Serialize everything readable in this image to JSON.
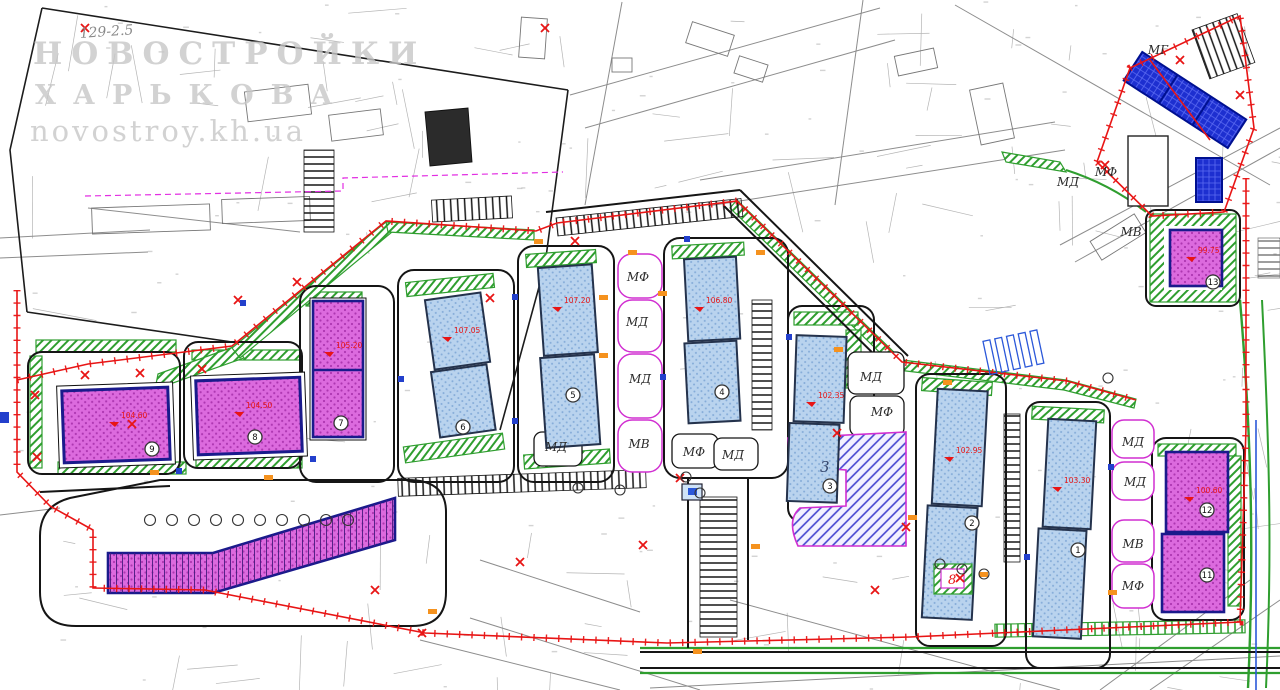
{
  "watermark": {
    "line1": "НОВОСТРОЙКИ",
    "line2": "ХАРЬКОВА",
    "line3": "novostroy.kh.ua"
  },
  "parcel_label": "129-2.5",
  "block_number": "3",
  "transformer_label": "8",
  "zone_labels": [
    {
      "text": "МФ",
      "x": 638,
      "y": 281
    },
    {
      "text": "МД",
      "x": 637,
      "y": 326
    },
    {
      "text": "МД",
      "x": 640,
      "y": 383
    },
    {
      "text": "МВ",
      "x": 639,
      "y": 448
    },
    {
      "text": "МД",
      "x": 556,
      "y": 451
    },
    {
      "text": "МФ",
      "x": 694,
      "y": 456
    },
    {
      "text": "МД",
      "x": 733,
      "y": 459
    },
    {
      "text": "МД",
      "x": 871,
      "y": 381
    },
    {
      "text": "МФ",
      "x": 882,
      "y": 416
    },
    {
      "text": "МД",
      "x": 1133,
      "y": 446
    },
    {
      "text": "МД",
      "x": 1135,
      "y": 486
    },
    {
      "text": "МВ",
      "x": 1133,
      "y": 548
    },
    {
      "text": "МФ",
      "x": 1133,
      "y": 590
    },
    {
      "text": "МД",
      "x": 1068,
      "y": 186
    },
    {
      "text": "МФ",
      "x": 1106,
      "y": 176
    },
    {
      "text": "МВ",
      "x": 1131,
      "y": 236
    },
    {
      "text": "МГ",
      "x": 1158,
      "y": 54
    }
  ],
  "buildings": [
    {
      "number": "9",
      "x": 152,
      "y": 449,
      "kind": "residential-magenta"
    },
    {
      "number": "8",
      "x": 255,
      "y": 437,
      "kind": "residential-magenta"
    },
    {
      "number": "7",
      "x": 341,
      "y": 423,
      "kind": "residential-magenta"
    },
    {
      "number": "6",
      "x": 463,
      "y": 427,
      "kind": "residential-blue"
    },
    {
      "number": "5",
      "x": 573,
      "y": 395,
      "kind": "residential-blue"
    },
    {
      "number": "4",
      "x": 722,
      "y": 392,
      "kind": "residential-blue"
    },
    {
      "number": "3",
      "x": 830,
      "y": 486,
      "kind": "residential-blue"
    },
    {
      "number": "2",
      "x": 972,
      "y": 523,
      "kind": "residential-blue"
    },
    {
      "number": "1",
      "x": 1078,
      "y": 550,
      "kind": "residential-blue"
    },
    {
      "number": "12",
      "x": 1207,
      "y": 510,
      "kind": "residential-magenta"
    },
    {
      "number": "11",
      "x": 1207,
      "y": 575,
      "kind": "residential-magenta"
    },
    {
      "number": "13",
      "x": 1213,
      "y": 282,
      "kind": "residential-magenta"
    }
  ],
  "level_marks": [
    {
      "text": "107.05",
      "x": 448,
      "y": 333
    },
    {
      "text": "107.20",
      "x": 558,
      "y": 303
    },
    {
      "text": "106.80",
      "x": 700,
      "y": 303
    },
    {
      "text": "102.35",
      "x": 812,
      "y": 398
    },
    {
      "text": "102.95",
      "x": 950,
      "y": 453
    },
    {
      "text": "103.30",
      "x": 1058,
      "y": 483
    },
    {
      "text": "105.20",
      "x": 330,
      "y": 348
    },
    {
      "text": "104.60",
      "x": 115,
      "y": 418
    },
    {
      "text": "104.50",
      "x": 240,
      "y": 408
    },
    {
      "text": "100.60",
      "x": 1190,
      "y": 493
    },
    {
      "text": "99.75",
      "x": 1192,
      "y": 253
    }
  ],
  "colors": {
    "magenta_building": "#d95fd9",
    "blue_building": "#b7d2ee",
    "dark_blue_building": "#1d2fd0",
    "landscape_green": "#2f9e2f",
    "boundary_red": "#e81515",
    "plot_line_magenta": "#d12fd1",
    "road_black": "#151515",
    "marker_orange": "#f5921e"
  }
}
